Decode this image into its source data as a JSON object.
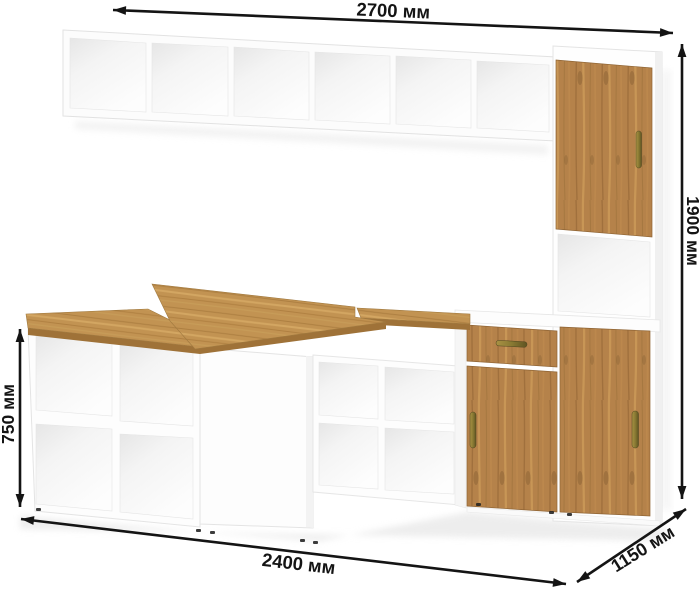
{
  "image_type": "furniture-dimension-render",
  "dimensions": {
    "width_top": "2700 мм",
    "height_right": "1900 мм",
    "desk_height_left": "750 мм",
    "width_bottom": "2400 мм",
    "depth_diagonal": "1150 мм"
  },
  "colors": {
    "background": "#ffffff",
    "dimension_line": "#141414",
    "carcass_white": "#fdfdfd",
    "carcass_shadow": "#ececec",
    "wood_mid": "#b98850",
    "wood_dark": "#9b6c3a",
    "wood_light": "#cfa05f",
    "desk_wood": "#c29352",
    "desk_edge": "#9f7238",
    "handle_brass": "#8a7a2f",
    "feet_black": "#222222"
  }
}
